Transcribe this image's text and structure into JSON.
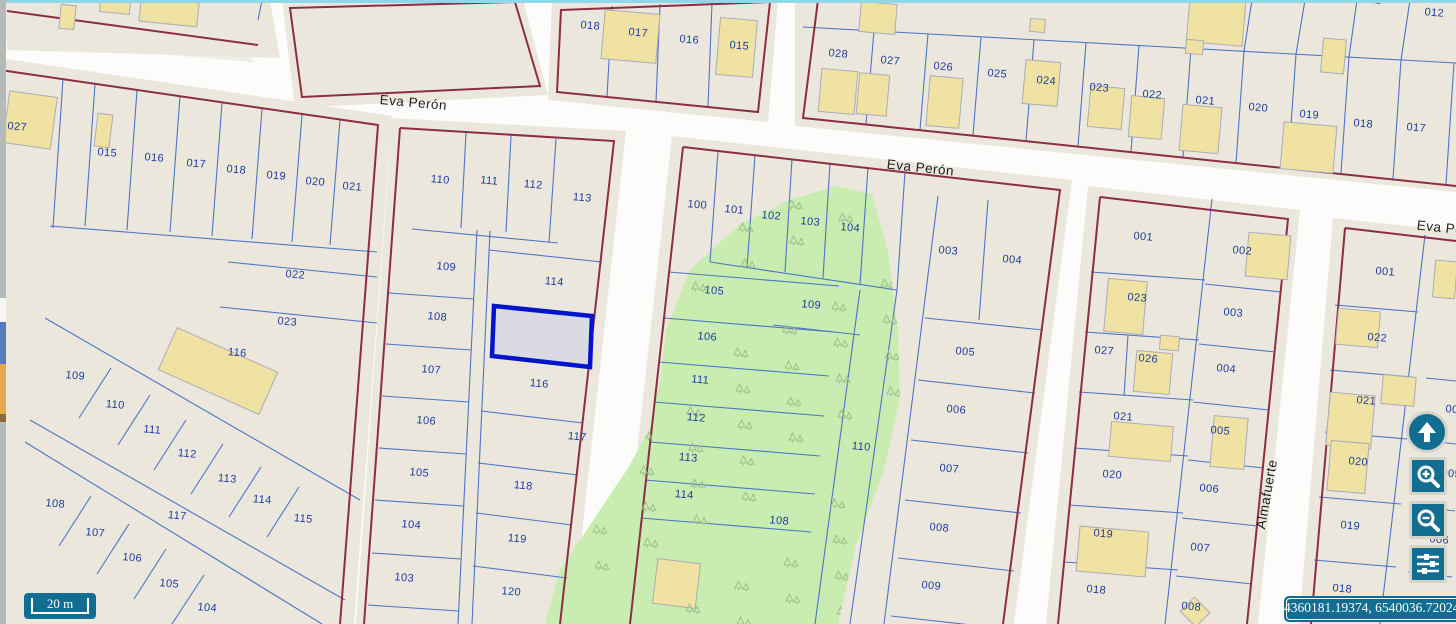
{
  "street_labels": [
    {
      "text": "Eva Perón",
      "x": 413,
      "y": 107,
      "rot": 5
    },
    {
      "text": "Eva Perón",
      "x": 920,
      "y": 172,
      "rot": 6
    },
    {
      "text": "Eva Perón",
      "x": 1450,
      "y": 233,
      "rot": 6
    },
    {
      "text": "Almafuerte",
      "x": 1271,
      "y": 495,
      "rot": -80
    }
  ],
  "parcels": [
    {
      "label": "018",
      "x": 590,
      "y": 29
    },
    {
      "label": "017",
      "x": 638,
      "y": 36
    },
    {
      "label": "016",
      "x": 689,
      "y": 43
    },
    {
      "label": "015",
      "x": 739,
      "y": 49
    },
    {
      "label": "028",
      "x": 838,
      "y": 57
    },
    {
      "label": "027",
      "x": 890,
      "y": 64
    },
    {
      "label": "026",
      "x": 943,
      "y": 70
    },
    {
      "label": "025",
      "x": 997,
      "y": 77
    },
    {
      "label": "024",
      "x": 1046,
      "y": 84
    },
    {
      "label": "023",
      "x": 1099,
      "y": 91
    },
    {
      "label": "022",
      "x": 1152,
      "y": 98
    },
    {
      "label": "021",
      "x": 1205,
      "y": 104
    },
    {
      "label": "020",
      "x": 1258,
      "y": 111
    },
    {
      "label": "019",
      "x": 1309,
      "y": 118
    },
    {
      "label": "018",
      "x": 1363,
      "y": 127
    },
    {
      "label": "017",
      "x": 1416,
      "y": 131
    },
    {
      "label": "012",
      "x": 1434,
      "y": 16
    },
    {
      "label": "011",
      "x": 1372,
      "y": 3
    },
    {
      "label": "027",
      "x": 17,
      "y": 130
    },
    {
      "label": "015",
      "x": 107,
      "y": 156
    },
    {
      "label": "016",
      "x": 154,
      "y": 161
    },
    {
      "label": "017",
      "x": 196,
      "y": 167
    },
    {
      "label": "018",
      "x": 236,
      "y": 173
    },
    {
      "label": "019",
      "x": 276,
      "y": 179
    },
    {
      "label": "020",
      "x": 315,
      "y": 185
    },
    {
      "label": "021",
      "x": 352,
      "y": 190
    },
    {
      "label": "022",
      "x": 295,
      "y": 278
    },
    {
      "label": "023",
      "x": 287,
      "y": 325
    },
    {
      "label": "116",
      "x": 237,
      "y": 356
    },
    {
      "label": "109",
      "x": 75,
      "y": 379
    },
    {
      "label": "110",
      "x": 115,
      "y": 408
    },
    {
      "label": "111",
      "x": 152,
      "y": 433
    },
    {
      "label": "112",
      "x": 187,
      "y": 457
    },
    {
      "label": "113",
      "x": 227,
      "y": 482
    },
    {
      "label": "114",
      "x": 262,
      "y": 503
    },
    {
      "label": "115",
      "x": 303,
      "y": 522
    },
    {
      "label": "108",
      "x": 55,
      "y": 507
    },
    {
      "label": "107",
      "x": 95,
      "y": 536
    },
    {
      "label": "106",
      "x": 132,
      "y": 561
    },
    {
      "label": "105",
      "x": 169,
      "y": 587
    },
    {
      "label": "104",
      "x": 207,
      "y": 611
    },
    {
      "label": "117",
      "x": 177,
      "y": 519
    },
    {
      "label": "110",
      "x": 440,
      "y": 183
    },
    {
      "label": "111",
      "x": 489,
      "y": 184
    },
    {
      "label": "112",
      "x": 533,
      "y": 188
    },
    {
      "label": "113",
      "x": 582,
      "y": 201
    },
    {
      "label": "109",
      "x": 446,
      "y": 270
    },
    {
      "label": "114",
      "x": 554,
      "y": 285
    },
    {
      "label": "108",
      "x": 437,
      "y": 320
    },
    {
      "label": "107",
      "x": 431,
      "y": 373
    },
    {
      "label": "116",
      "x": 539,
      "y": 387
    },
    {
      "label": "106",
      "x": 426,
      "y": 424
    },
    {
      "label": "117",
      "x": 577,
      "y": 440
    },
    {
      "label": "105",
      "x": 419,
      "y": 476
    },
    {
      "label": "118",
      "x": 523,
      "y": 489
    },
    {
      "label": "104",
      "x": 411,
      "y": 528
    },
    {
      "label": "119",
      "x": 517,
      "y": 542
    },
    {
      "label": "103",
      "x": 404,
      "y": 581
    },
    {
      "label": "120",
      "x": 511,
      "y": 595
    },
    {
      "label": "100",
      "x": 697,
      "y": 208
    },
    {
      "label": "101",
      "x": 734,
      "y": 213
    },
    {
      "label": "102",
      "x": 771,
      "y": 219
    },
    {
      "label": "103",
      "x": 810,
      "y": 225
    },
    {
      "label": "104",
      "x": 850,
      "y": 231
    },
    {
      "label": "105",
      "x": 714,
      "y": 294
    },
    {
      "label": "106",
      "x": 707,
      "y": 340
    },
    {
      "label": "111",
      "x": 700,
      "y": 383
    },
    {
      "label": "112",
      "x": 696,
      "y": 421
    },
    {
      "label": "113",
      "x": 688,
      "y": 461
    },
    {
      "label": "114",
      "x": 684,
      "y": 498
    },
    {
      "label": "109",
      "x": 811,
      "y": 308
    },
    {
      "label": "110",
      "x": 861,
      "y": 450
    },
    {
      "label": "108",
      "x": 779,
      "y": 524
    },
    {
      "label": "003",
      "x": 948,
      "y": 254
    },
    {
      "label": "004",
      "x": 1012,
      "y": 263
    },
    {
      "label": "005",
      "x": 965,
      "y": 355
    },
    {
      "label": "006",
      "x": 956,
      "y": 413
    },
    {
      "label": "007",
      "x": 949,
      "y": 472
    },
    {
      "label": "008",
      "x": 939,
      "y": 531
    },
    {
      "label": "009",
      "x": 931,
      "y": 589
    },
    {
      "label": "001",
      "x": 1143,
      "y": 240
    },
    {
      "label": "002",
      "x": 1242,
      "y": 254
    },
    {
      "label": "023",
      "x": 1137,
      "y": 301
    },
    {
      "label": "003",
      "x": 1233,
      "y": 316
    },
    {
      "label": "027",
      "x": 1104,
      "y": 354
    },
    {
      "label": "026",
      "x": 1148,
      "y": 362
    },
    {
      "label": "004",
      "x": 1226,
      "y": 372
    },
    {
      "label": "021",
      "x": 1123,
      "y": 420
    },
    {
      "label": "005",
      "x": 1220,
      "y": 434
    },
    {
      "label": "020",
      "x": 1112,
      "y": 478
    },
    {
      "label": "006",
      "x": 1209,
      "y": 492
    },
    {
      "label": "019",
      "x": 1103,
      "y": 537
    },
    {
      "label": "007",
      "x": 1200,
      "y": 551
    },
    {
      "label": "018",
      "x": 1096,
      "y": 593
    },
    {
      "label": "008",
      "x": 1191,
      "y": 610
    },
    {
      "label": "001",
      "x": 1385,
      "y": 275
    },
    {
      "label": "022",
      "x": 1377,
      "y": 341
    },
    {
      "label": "021",
      "x": 1366,
      "y": 404
    },
    {
      "label": "020",
      "x": 1358,
      "y": 465
    },
    {
      "label": "019",
      "x": 1350,
      "y": 529
    },
    {
      "label": "018",
      "x": 1342,
      "y": 592
    },
    {
      "label": "004",
      "x": 1455,
      "y": 413
    },
    {
      "label": "005",
      "x": 1451,
      "y": 477
    },
    {
      "label": "006",
      "x": 1439,
      "y": 543
    }
  ],
  "ui": {
    "scale_bar_label": "20 m",
    "coordinates": "4360181.19374, 6540036.72024",
    "controls": [
      {
        "name": "pan-up"
      },
      {
        "name": "zoom-in"
      },
      {
        "name": "zoom-out"
      },
      {
        "name": "layer-settings"
      }
    ]
  },
  "colors": {
    "accent_teal": "#116e92",
    "parcel_line": "#4d74c6",
    "label_blue": "#1d3c9c",
    "block_outline": "#8c2d43",
    "building_fill": "#f0e2a2",
    "building_stroke": "#a9adb8",
    "park_fill": "#c9edb0",
    "tree_green": "#9cc08c",
    "street_white": "#fcfcfa",
    "block_fill": "#ebe7dd",
    "background": "#f0ede6",
    "selected_fill": "#d9dae2",
    "selected_stroke": "#0014cc",
    "street_text": "#1f1f1f"
  }
}
